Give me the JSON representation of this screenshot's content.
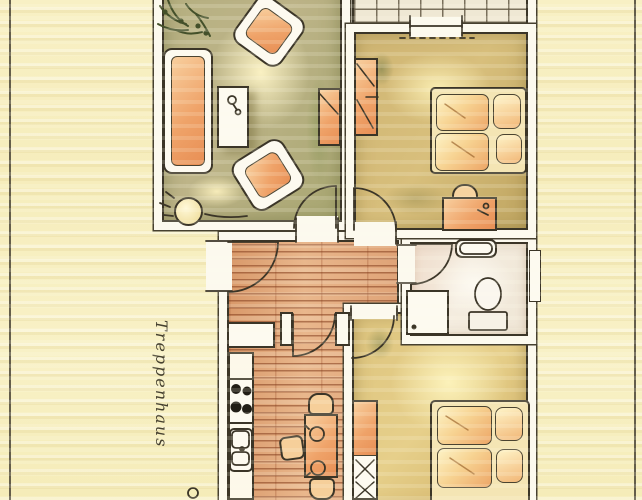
{
  "labels": {
    "staircase": "Treppenhaus"
  },
  "palette": {
    "paper": "#f7efc2",
    "ink": "#3b3527",
    "wall_fill": "#fcf9ee",
    "wood_floor": "#e2aa7c",
    "wood_plank_line": "#8a4526",
    "living_room_wash": "#b3ad7c",
    "bedroom_wash": "#cdb271",
    "bedroom2_wash": "#e3cc84",
    "bathroom_floor": "#f2e9dc",
    "balcony_tile": "#efe8d4",
    "tile_grout": "#6f6754",
    "furniture_orange": "#efa871",
    "highlight_glow": "#fdf3bc",
    "plant_green": "#44502a"
  }
}
